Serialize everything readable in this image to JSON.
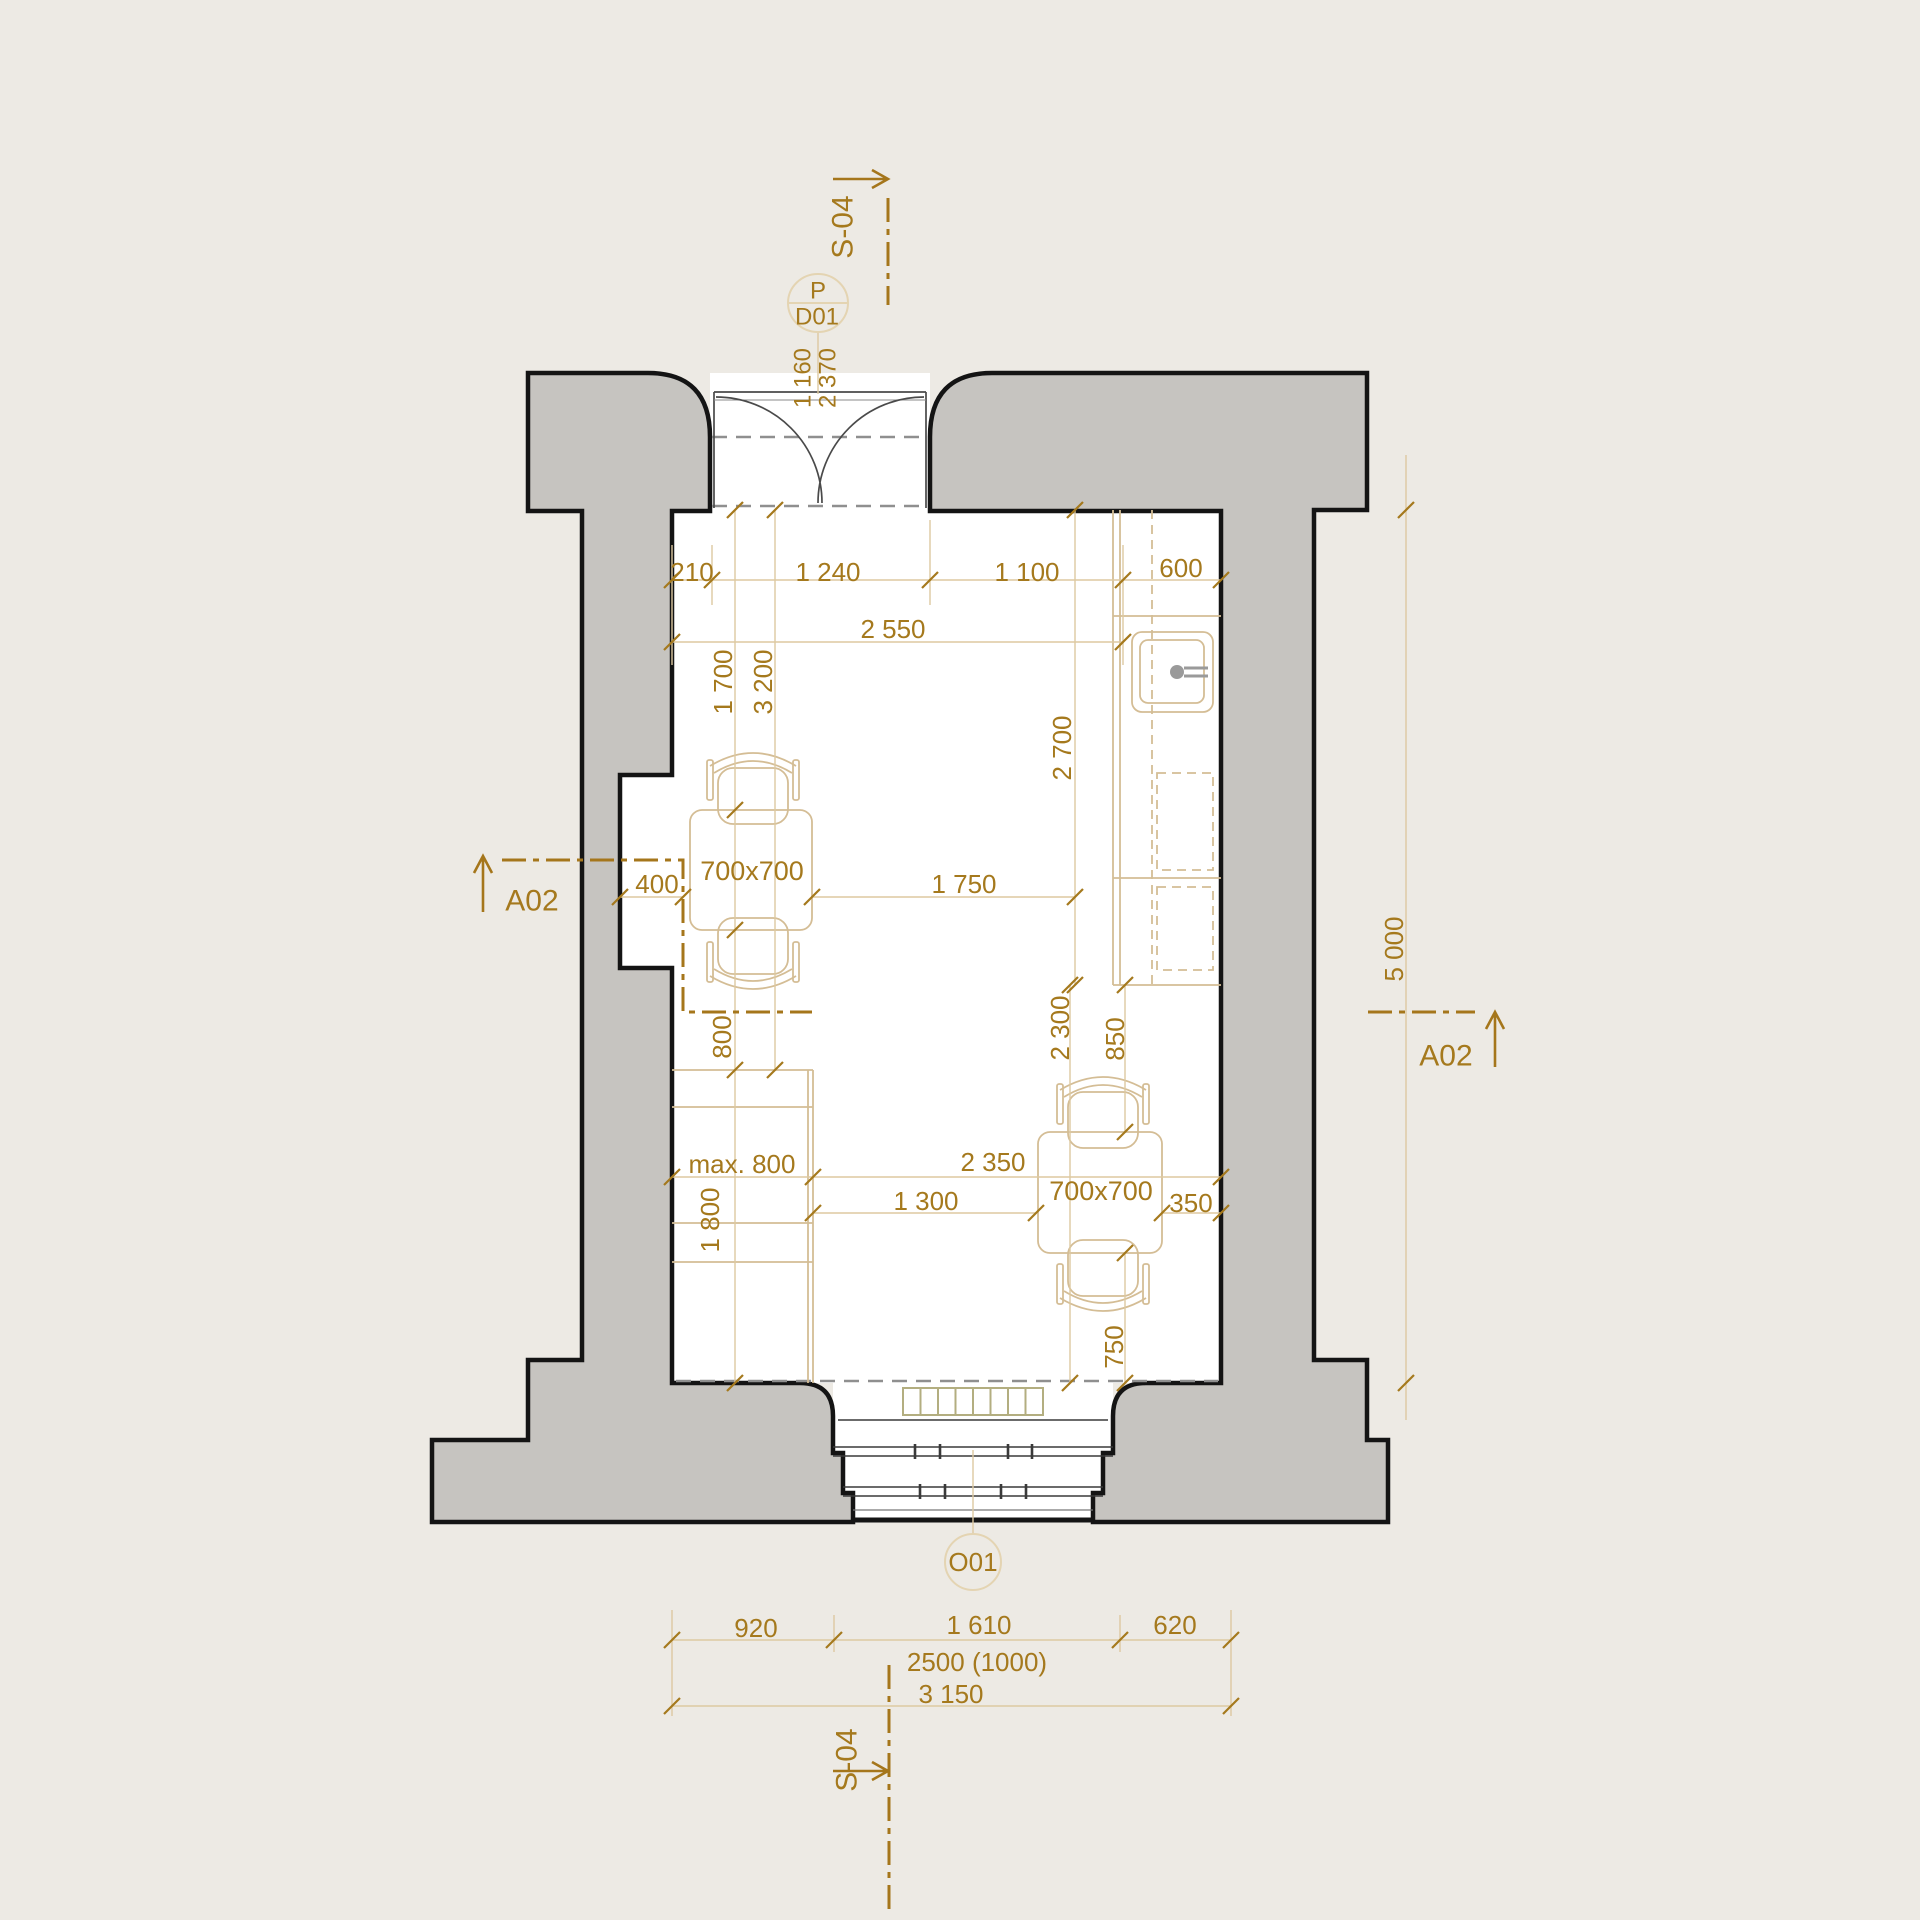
{
  "colors": {
    "background": "#edeae4",
    "wall_fill": "#c6c4c0",
    "outline": "#141414",
    "annotation": "#a5791d",
    "section_line": "#a5761b",
    "furniture": "#d4bd95",
    "witness": "#ddc9a1",
    "tag_circle": "#e4d4b2",
    "radiator": "#b3ae80",
    "hidden_line": "#8f8f8f"
  },
  "sections": {
    "s04_top": "S-04",
    "s04_bottom": "S-04",
    "a02_left": "A02",
    "a02_right": "A02"
  },
  "door": {
    "type_label": "P",
    "tag": "D01",
    "clear_width": "1 160",
    "clear_height": "2 370"
  },
  "window": {
    "tag": "O01"
  },
  "furniture": {
    "table_left": "700x700",
    "table_right": "700x700"
  },
  "dimensions": {
    "top_row": {
      "a": "210",
      "b": "1 240",
      "c": "1 100",
      "d": "600"
    },
    "top_total": "2 550",
    "left_top": {
      "a": "1 700",
      "b": "3 200"
    },
    "kitchen_depth": "2 700",
    "niche": "400",
    "mid": "1 750",
    "left_mid": "800",
    "right_mid": {
      "a": "2 300",
      "b": "850"
    },
    "counter": "max. 800",
    "lower": {
      "a": "2 350",
      "b": "1 300",
      "c": "350"
    },
    "left_bottom": "1 800",
    "right_bottom": "750",
    "room_height": "5 000",
    "bottom_row": {
      "a": "920",
      "b": "1 610",
      "c": "620"
    },
    "window_note": "2500 (1000)",
    "bottom_total": "3 150"
  }
}
